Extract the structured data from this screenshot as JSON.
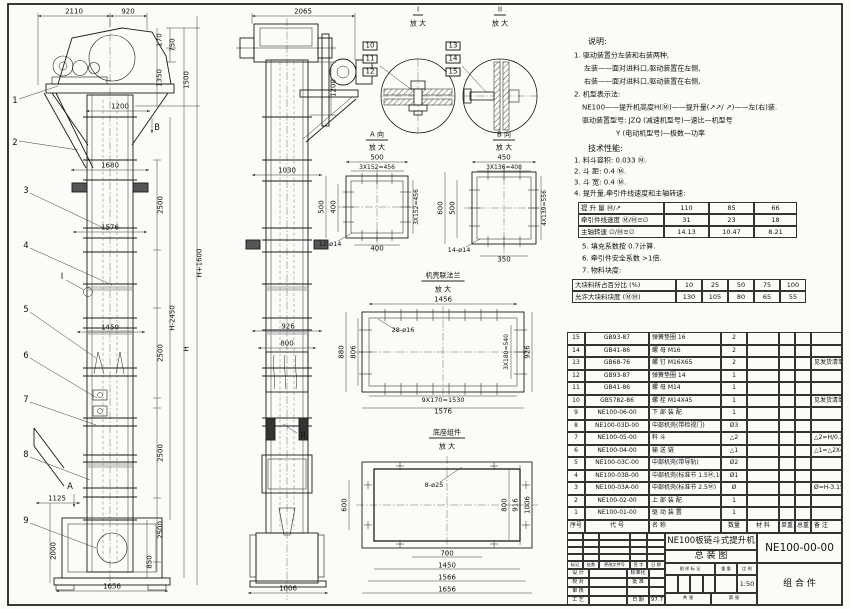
{
  "document": {
    "title_line1": "NE100板链斗式提升机",
    "title_line2": "总  装  图",
    "drawing_number": "NE100-00-00",
    "part_type": "组 合 件",
    "scale": "1:50",
    "date": "97.7"
  },
  "notes": [
    {
      "t": "说明:",
      "x": 588,
      "y": 42,
      "hd": true
    },
    {
      "t": "1. 驱动装置分左装和右装两种,",
      "x": 574,
      "y": 56
    },
    {
      "t": "左装——面对进料口,驱动装置在左侧,",
      "x": 584,
      "y": 69
    },
    {
      "t": "右装——面对进料口,驱动装置在右侧,",
      "x": 584,
      "y": 82
    },
    {
      "t": "2. 机型表示法:",
      "x": 574,
      "y": 95
    },
    {
      "t": "NE100——提升机高度H(Ⓜ)——提升量(↗↗/ ↗)——左(右)装.",
      "x": 582,
      "y": 108
    },
    {
      "t": "驱动装置型号: JZQ (减速机型号)—速比—机型号",
      "x": 582,
      "y": 121
    },
    {
      "t": "Y (电动机型号)—极数—功率",
      "x": 616,
      "y": 134
    },
    {
      "t": "技术性能:",
      "x": 588,
      "y": 149,
      "hd": true
    },
    {
      "t": "1. 料斗容积: 0.033 Ⓜ.",
      "x": 574,
      "y": 161
    },
    {
      "t": "2. 斗  距: 0.4 Ⓜ.",
      "x": 574,
      "y": 172
    },
    {
      "t": "3. 斗  宽: 0.4 Ⓜ.",
      "x": 574,
      "y": 183
    },
    {
      "t": "4. 提升量,牵引件线速度和主轴转速:",
      "x": 574,
      "y": 194
    },
    {
      "t": "5. 填充系数按 0.7计算.",
      "x": 582,
      "y": 247
    },
    {
      "t": "6. 牵引件安全系数 >1倍.",
      "x": 582,
      "y": 259
    },
    {
      "t": "7. 物料块度:",
      "x": 582,
      "y": 271
    }
  ],
  "spec_tables": [
    {
      "name": "lift-capacity-table",
      "x": 578,
      "y": 202,
      "widths": [
        86,
        45,
        45,
        43
      ],
      "rowH": 12,
      "fs": 6.5,
      "leftCols": [
        0
      ],
      "rows": [
        [
          "提 升 量  Ⓜ/↗",
          "110",
          "85",
          "66"
        ],
        [
          "牵引件线速度 Ⓜ/Ⓜ≡∅",
          "31",
          "23",
          "18"
        ],
        [
          "主轴转速  ∅/Ⓜ≡∅",
          "14.13",
          "10.47",
          "8.21"
        ]
      ]
    },
    {
      "name": "lump-size-table",
      "x": 572,
      "y": 279,
      "widths": [
        104,
        26,
        26,
        26,
        26,
        26
      ],
      "rowH": 12,
      "fs": 6.5,
      "leftCols": [
        0
      ],
      "rows": [
        [
          "大块料所占百分比 (%)",
          "10",
          "25",
          "50",
          "75",
          "100"
        ],
        [
          "允许大块料块度 (ⓂⓂ)",
          "130",
          "105",
          "80",
          "65",
          "55"
        ]
      ]
    }
  ],
  "parts_list": {
    "x": 567,
    "y": 332,
    "widths": [
      18,
      64,
      72,
      26,
      32,
      16,
      16,
      31
    ],
    "rowH": 12.5,
    "headerH": 13,
    "fs": 6,
    "leftCols": [
      2,
      7
    ],
    "header": [
      "序号",
      "代  号",
      "名  称",
      "数量",
      "材  料",
      "单重",
      "总重",
      "备 注"
    ],
    "rows": [
      [
        "15",
        "GB93-87",
        "弹簧垫圈 16",
        "2",
        "",
        "",
        "",
        ""
      ],
      [
        "14",
        "GB41-86",
        "螺 母 M16",
        "2",
        "",
        "",
        "",
        ""
      ],
      [
        "13",
        "GB68-76",
        "螺 钉 M16X65",
        "2",
        "",
        "",
        "",
        "见发货清单"
      ],
      [
        "12",
        "GB93-87",
        "弹簧垫圈 14",
        "1",
        "",
        "",
        "",
        ""
      ],
      [
        "11",
        "GB41-86",
        "螺 母 M14",
        "1",
        "",
        "",
        "",
        ""
      ],
      [
        "10",
        "GB5782-86",
        "螺 栓 M14X45",
        "1",
        "",
        "",
        "",
        "见发货清单"
      ],
      [
        "9",
        "NE100-06-00",
        "下 部 装 配",
        "1",
        "",
        "",
        "",
        ""
      ],
      [
        "8",
        "NE100-03D-00",
        "中部机壳(带检视门)",
        "Ø3",
        "",
        "",
        "",
        ""
      ],
      [
        "7",
        "NE100-05-00",
        "料 斗",
        "△2",
        "",
        "",
        "",
        "△2=H/0.2+5.75"
      ],
      [
        "6",
        "NE100-04-00",
        "输 送 链",
        "△1",
        "",
        "",
        "",
        "△1=△2X4"
      ],
      [
        "5",
        "NE100-03C-00",
        "中部机壳(带导轨)",
        "Ø2",
        "",
        "",
        "",
        ""
      ],
      [
        "4",
        "NE100-03B-00",
        "中部机壳(标准节 1.5Ⓜ,1Ⓜ)",
        "Ø1",
        "",
        "",
        "",
        ""
      ],
      [
        "3",
        "NE100-03A-00",
        "中部机壳(标准节 2.5Ⓜ)",
        "Ø",
        "",
        "",
        "",
        "Ø=H-3.15/2.5"
      ],
      [
        "2",
        "NE100-02-00",
        "上 部 装 配",
        "1",
        "",
        "",
        "",
        ""
      ],
      [
        "1",
        "NE100-01-00",
        "驱 动 装 置",
        "1",
        "",
        "",
        "",
        ""
      ]
    ]
  },
  "title_block": {
    "grids": [
      {
        "name": "revision-blank-grid",
        "x": 567,
        "y": 533,
        "widths": [
          16,
          16,
          31,
          17,
          18
        ],
        "heights": [
          7,
          7,
          7,
          7
        ],
        "rows": [
          [
            "",
            "",
            "",
            "",
            ""
          ],
          [
            "",
            "",
            "",
            "",
            ""
          ],
          [
            "",
            "",
            "",
            "",
            ""
          ],
          [
            "",
            "",
            "",
            "",
            ""
          ]
        ],
        "fs": 4.2
      },
      {
        "name": "mark-boxes-grid",
        "x": 665,
        "y": 575,
        "widths": [
          12.5,
          12.5,
          12.5,
          12.5
        ],
        "heights": [
          18
        ],
        "rows": [
          [
            "",
            "",
            "",
            ""
          ]
        ],
        "fs": 5
      }
    ],
    "cells": [
      {
        "x": 567,
        "y": 561,
        "w": 16,
        "h": 8,
        "t": "标记",
        "fs": 4.2
      },
      {
        "x": 583,
        "y": 561,
        "w": 16,
        "h": 8,
        "t": "处数",
        "fs": 4.2
      },
      {
        "x": 599,
        "y": 561,
        "w": 31,
        "h": 8,
        "t": "更改文件号",
        "fs": 4.2
      },
      {
        "x": 630,
        "y": 561,
        "w": 17,
        "h": 8,
        "t": "签 字",
        "fs": 4.2
      },
      {
        "x": 647,
        "y": 561,
        "w": 18,
        "h": 8,
        "t": "日 期",
        "fs": 4.2
      },
      {
        "x": 567,
        "y": 569,
        "w": 22,
        "h": 9,
        "t": "设 计",
        "fs": 5
      },
      {
        "x": 589,
        "y": 569,
        "w": 38,
        "h": 9,
        "t": "",
        "fs": 5
      },
      {
        "x": 627,
        "y": 569,
        "w": 22,
        "h": 9,
        "t": "标准化",
        "fs": 5
      },
      {
        "x": 649,
        "y": 569,
        "w": 16,
        "h": 9,
        "t": "",
        "fs": 5
      },
      {
        "x": 567,
        "y": 578,
        "w": 22,
        "h": 9,
        "t": "校 对",
        "fs": 5
      },
      {
        "x": 589,
        "y": 578,
        "w": 38,
        "h": 9,
        "t": "",
        "fs": 5
      },
      {
        "x": 627,
        "y": 578,
        "w": 22,
        "h": 9,
        "t": "批 准",
        "fs": 5
      },
      {
        "x": 649,
        "y": 578,
        "w": 16,
        "h": 9,
        "t": "",
        "fs": 5
      },
      {
        "x": 567,
        "y": 587,
        "w": 22,
        "h": 9,
        "t": "审 核",
        "fs": 5
      },
      {
        "x": 589,
        "y": 587,
        "w": 38,
        "h": 9,
        "t": "",
        "fs": 5
      },
      {
        "x": 627,
        "y": 587,
        "w": 22,
        "h": 9,
        "t": "",
        "fs": 5
      },
      {
        "x": 649,
        "y": 587,
        "w": 16,
        "h": 9,
        "t": "",
        "fs": 5
      },
      {
        "x": 567,
        "y": 596,
        "w": 22,
        "h": 9,
        "t": "工 艺",
        "fs": 5
      },
      {
        "x": 589,
        "y": 596,
        "w": 38,
        "h": 9,
        "t": "",
        "fs": 5
      },
      {
        "x": 627,
        "y": 596,
        "w": 22,
        "h": 9,
        "t": "日 期",
        "fs": 5
      },
      {
        "x": 649,
        "y": 596,
        "w": 16,
        "h": 9,
        "t": "97.7",
        "fs": 5.5
      },
      {
        "x": 665,
        "y": 533,
        "w": 92,
        "h": 17,
        "t": "NE100板链斗式提升机",
        "fs": 8.5
      },
      {
        "x": 665,
        "y": 550,
        "w": 92,
        "h": 13,
        "t": "总  装  图",
        "fs": 9
      },
      {
        "x": 665,
        "y": 563,
        "w": 50,
        "h": 12,
        "t": "图 样 标 记",
        "fs": 4.2
      },
      {
        "x": 715,
        "y": 563,
        "w": 22,
        "h": 12,
        "t": "重 量",
        "fs": 4.2
      },
      {
        "x": 737,
        "y": 563,
        "w": 20,
        "h": 12,
        "t": "比 例",
        "fs": 4.2
      },
      {
        "x": 715,
        "y": 575,
        "w": 22,
        "h": 18,
        "t": "",
        "fs": 5
      },
      {
        "x": 737,
        "y": 575,
        "w": 20,
        "h": 18,
        "t": "1:50",
        "fs": 6.5
      },
      {
        "x": 665,
        "y": 593,
        "w": 46,
        "h": 12,
        "t": "共    张",
        "fs": 4.5
      },
      {
        "x": 711,
        "y": 593,
        "w": 46,
        "h": 12,
        "t": "第    张",
        "fs": 4.5
      },
      {
        "x": 757,
        "y": 533,
        "w": 85,
        "h": 30,
        "t": "NE100-00-00",
        "fs": 10.5
      },
      {
        "x": 757,
        "y": 563,
        "w": 85,
        "h": 42,
        "t": "组 合 件",
        "fs": 9
      }
    ]
  },
  "drawing_labels": [
    {
      "t": "2110",
      "x": 74,
      "y": 12
    },
    {
      "t": "920",
      "x": 128,
      "y": 12
    },
    {
      "t": "170",
      "x": 160,
      "y": 40,
      "r": 1
    },
    {
      "t": "750",
      "x": 173,
      "y": 45,
      "r": 1
    },
    {
      "t": "1350",
      "x": 160,
      "y": 78,
      "r": 1
    },
    {
      "t": "1500",
      "x": 187,
      "y": 80,
      "r": 1
    },
    {
      "t": "1200",
      "x": 120,
      "y": 107
    },
    {
      "t": "B",
      "x": 157,
      "y": 128,
      "k": "c"
    },
    {
      "t": "1",
      "x": 15,
      "y": 101,
      "k": "c"
    },
    {
      "t": "2",
      "x": 15,
      "y": 143,
      "k": "c"
    },
    {
      "t": "1680",
      "x": 110,
      "y": 166
    },
    {
      "t": "2500",
      "x": 161,
      "y": 205,
      "r": 1
    },
    {
      "t": "1576",
      "x": 110,
      "y": 228
    },
    {
      "t": "3",
      "x": 26,
      "y": 191,
      "k": "c"
    },
    {
      "t": "4",
      "x": 26,
      "y": 246,
      "k": "c"
    },
    {
      "t": "I",
      "x": 62,
      "y": 277,
      "k": "c"
    },
    {
      "t": "H+1600",
      "x": 200,
      "y": 263,
      "r": 1
    },
    {
      "t": "H-2450",
      "x": 173,
      "y": 318,
      "r": 1
    },
    {
      "t": "H",
      "x": 187,
      "y": 349,
      "r": 1
    },
    {
      "t": "1450",
      "x": 110,
      "y": 328
    },
    {
      "t": "2500",
      "x": 161,
      "y": 353,
      "r": 1
    },
    {
      "t": "5",
      "x": 26,
      "y": 310,
      "k": "c"
    },
    {
      "t": "6",
      "x": 26,
      "y": 356,
      "k": "c"
    },
    {
      "t": "7",
      "x": 26,
      "y": 400,
      "k": "c"
    },
    {
      "t": "8",
      "x": 26,
      "y": 455,
      "k": "c"
    },
    {
      "t": "2500",
      "x": 161,
      "y": 453,
      "r": 1
    },
    {
      "t": "A",
      "x": 70,
      "y": 487,
      "k": "c"
    },
    {
      "t": "1125",
      "x": 57,
      "y": 499
    },
    {
      "t": "9",
      "x": 26,
      "y": 521,
      "k": "c"
    },
    {
      "t": "2000",
      "x": 54,
      "y": 551,
      "r": 1
    },
    {
      "t": "2500",
      "x": 161,
      "y": 530,
      "r": 1
    },
    {
      "t": "850",
      "x": 150,
      "y": 562,
      "r": 1
    },
    {
      "t": "1656",
      "x": 112,
      "y": 587
    },
    {
      "t": "2065",
      "x": 303,
      "y": 12
    },
    {
      "t": "1200",
      "x": 334,
      "y": 88,
      "r": 1
    },
    {
      "t": "1030",
      "x": 287,
      "y": 171
    },
    {
      "t": "926",
      "x": 288,
      "y": 327
    },
    {
      "t": "800",
      "x": 287,
      "y": 344
    },
    {
      "t": "II",
      "x": 303,
      "y": 436,
      "k": "c"
    },
    {
      "t": "1006",
      "x": 288,
      "y": 589
    },
    {
      "t": "I",
      "x": 418,
      "y": 11,
      "k": "tt"
    },
    {
      "t": "放 大",
      "x": 418,
      "y": 24,
      "k": "t"
    },
    {
      "t": "10",
      "x": 370,
      "y": 46,
      "k": "b"
    },
    {
      "t": "11",
      "x": 370,
      "y": 59,
      "k": "b"
    },
    {
      "t": "12",
      "x": 370,
      "y": 72,
      "k": "b"
    },
    {
      "t": "II",
      "x": 500,
      "y": 11,
      "k": "tt"
    },
    {
      "t": "放 大",
      "x": 500,
      "y": 24,
      "k": "t"
    },
    {
      "t": "13",
      "x": 453,
      "y": 46,
      "k": "b"
    },
    {
      "t": "14",
      "x": 453,
      "y": 59,
      "k": "b"
    },
    {
      "t": "15",
      "x": 453,
      "y": 72,
      "k": "b"
    },
    {
      "t": "A 向",
      "x": 377,
      "y": 136,
      "k": "tt"
    },
    {
      "t": "放 大",
      "x": 377,
      "y": 148,
      "k": "t"
    },
    {
      "t": "500",
      "x": 377,
      "y": 158
    },
    {
      "t": "3X152=456",
      "x": 377,
      "y": 168,
      "s": 6
    },
    {
      "t": "500",
      "x": 322,
      "y": 207,
      "r": 1
    },
    {
      "t": "400",
      "x": 334,
      "y": 207,
      "r": 1
    },
    {
      "t": "3X152=456",
      "x": 417,
      "y": 207,
      "r": 1,
      "s": 6
    },
    {
      "t": "12-ø14",
      "x": 330,
      "y": 244,
      "s": 6.5
    },
    {
      "t": "400",
      "x": 377,
      "y": 249
    },
    {
      "t": "B 向",
      "x": 504,
      "y": 136,
      "k": "tt"
    },
    {
      "t": "放 大",
      "x": 504,
      "y": 148,
      "k": "t"
    },
    {
      "t": "450",
      "x": 504,
      "y": 158
    },
    {
      "t": "3X136=408",
      "x": 504,
      "y": 168,
      "s": 6
    },
    {
      "t": "600",
      "x": 441,
      "y": 208,
      "r": 1
    },
    {
      "t": "500",
      "x": 453,
      "y": 208,
      "r": 1
    },
    {
      "t": "4X139=556",
      "x": 545,
      "y": 208,
      "r": 1,
      "s": 6
    },
    {
      "t": "14-ø14",
      "x": 459,
      "y": 250,
      "s": 6.5
    },
    {
      "t": "350",
      "x": 504,
      "y": 260
    },
    {
      "t": "机壳联法兰",
      "x": 443,
      "y": 277,
      "k": "tt"
    },
    {
      "t": "放 大",
      "x": 443,
      "y": 290,
      "k": "t"
    },
    {
      "t": "1456",
      "x": 443,
      "y": 300
    },
    {
      "t": "28-ø16",
      "x": 403,
      "y": 330,
      "s": 6.5
    },
    {
      "t": "880",
      "x": 342,
      "y": 352,
      "r": 1
    },
    {
      "t": "806",
      "x": 354,
      "y": 352,
      "r": 1
    },
    {
      "t": "3X180=540",
      "x": 507,
      "y": 352,
      "r": 1,
      "s": 6
    },
    {
      "t": "926",
      "x": 528,
      "y": 352,
      "r": 1
    },
    {
      "t": "9X170=1530",
      "x": 443,
      "y": 400,
      "s": 6.5
    },
    {
      "t": "1576",
      "x": 443,
      "y": 412
    },
    {
      "t": "底座组件",
      "x": 447,
      "y": 434,
      "k": "tt"
    },
    {
      "t": "放 大",
      "x": 447,
      "y": 447,
      "k": "t"
    },
    {
      "t": "8-ø25",
      "x": 434,
      "y": 485,
      "s": 6.5
    },
    {
      "t": "600",
      "x": 345,
      "y": 505,
      "r": 1
    },
    {
      "t": "800",
      "x": 505,
      "y": 505,
      "r": 1
    },
    {
      "t": "916",
      "x": 516,
      "y": 505,
      "r": 1
    },
    {
      "t": "1006",
      "x": 528,
      "y": 505,
      "r": 1
    },
    {
      "t": "700",
      "x": 447,
      "y": 554
    },
    {
      "t": "1450",
      "x": 447,
      "y": 566
    },
    {
      "t": "1566",
      "x": 447,
      "y": 578
    },
    {
      "t": "1656",
      "x": 447,
      "y": 590
    }
  ]
}
